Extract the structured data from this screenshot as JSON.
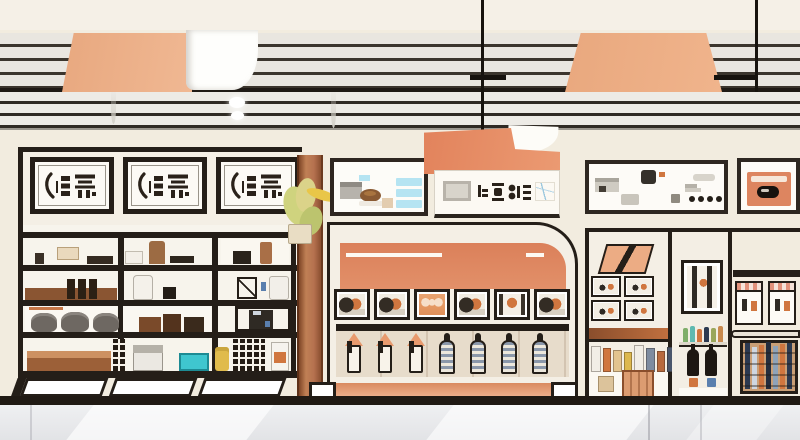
{
  "meta": {
    "title": "Stylized storefront interior illustration",
    "style": "flat vector shop scene with shelving, plaques and pendant lamp"
  },
  "palette": {
    "wall": "#f2ecdf",
    "panel": "#f4efe5",
    "white": "#fbf9f4",
    "dark": "#241e18",
    "peach": "#ecac84",
    "peach_deep": "#e89a6e",
    "salmon": "#dd8560",
    "salmon_light": "#eeb08d",
    "sienna": "#b5714f",
    "brown": "#9c6038",
    "teal": "#3fc6cf",
    "cyan": "#b5e4f2",
    "navy": "#2c3950",
    "orange": "#d0763f",
    "yellow": "#ddb84e",
    "glyph": "#2a221a",
    "floor": "#e9eaec"
  },
  "ceiling": {
    "recessed_lights": 2,
    "pendant_cords": 2,
    "lamp_shade": "peach trapezoid"
  },
  "signage": {
    "left_plaques": [
      {
        "alt": "framed plaque, illegible brush calligraphy"
      },
      {
        "alt": "framed plaque, illegible brush calligraphy"
      },
      {
        "alt": "framed plaque, illegible brush calligraphy"
      }
    ],
    "hanging_sign": {
      "alt": "orange awning sign, illegible characters and product photos"
    },
    "menu_board": {
      "price_lines": 3
    },
    "right_board": {
      "dots": [
        {},
        {},
        {},
        {}
      ]
    },
    "right_orange_frame": {
      "alt": "framed orange product card"
    }
  },
  "left_shelf": {
    "rows": 4,
    "cols": 3
  },
  "center_cabinet": {
    "pictures": [
      {
        "cls": "pic-duo"
      },
      {
        "cls": "pic-duo"
      },
      {
        "cls": "pic-solid"
      },
      {
        "cls": "pic-duo"
      },
      {
        "cls": "pic-fig"
      },
      {
        "cls": "pic-duo"
      }
    ],
    "bottles": [
      {
        "cls": "bottle-orange"
      },
      {
        "cls": "bottle-orange"
      },
      {
        "cls": "bottle-orange"
      },
      {
        "cls": "bottle-striped"
      },
      {
        "cls": "bottle-striped"
      },
      {
        "cls": "bottle-striped"
      },
      {
        "cls": "bottle-striped"
      }
    ]
  },
  "right_section": {
    "mini_frames": [
      {},
      {},
      {},
      {}
    ],
    "awning_frames": [
      {},
      {}
    ],
    "shelf_products": [
      {
        "c": "#f2eee6",
        "w": "10px",
        "h": "26px"
      },
      {
        "c": "#d0763f",
        "w": "8px",
        "h": "24px"
      },
      {
        "c": "#e3c48f",
        "w": "9px",
        "h": "22px"
      },
      {
        "c": "#ddb84e",
        "w": "8px",
        "h": "20px"
      },
      {
        "c": "#f2eee6",
        "w": "10px",
        "h": "27px"
      },
      {
        "c": "#7e8ca0",
        "w": "9px",
        "h": "24px"
      },
      {
        "c": "#b86a3e",
        "w": "8px",
        "h": "21px"
      },
      {
        "c": "#4a566b",
        "w": "9px",
        "h": "25px"
      }
    ],
    "mini_bottles": [
      {
        "c": "#7fae6a",
        "h": "14px"
      },
      {
        "c": "#5fb9b0",
        "h": "16px"
      },
      {
        "c": "#d0763f",
        "h": "13px"
      },
      {
        "c": "#2c3950",
        "h": "15px"
      },
      {
        "c": "#9aa65a",
        "h": "14px"
      },
      {
        "c": "#c98a4e",
        "h": "16px"
      }
    ],
    "crate_stripes": [
      {
        "c": "#2c3950",
        "h": "46px"
      },
      {
        "c": "#cfd6df",
        "h": "42px"
      },
      {
        "c": "#d0763f",
        "h": "44px"
      },
      {
        "c": "#222c3d",
        "h": "47px"
      },
      {
        "c": "#8fa3b8",
        "h": "43px"
      },
      {
        "c": "#d0763f",
        "h": "45px"
      },
      {
        "c": "#2c3950",
        "h": "46px"
      }
    ]
  }
}
